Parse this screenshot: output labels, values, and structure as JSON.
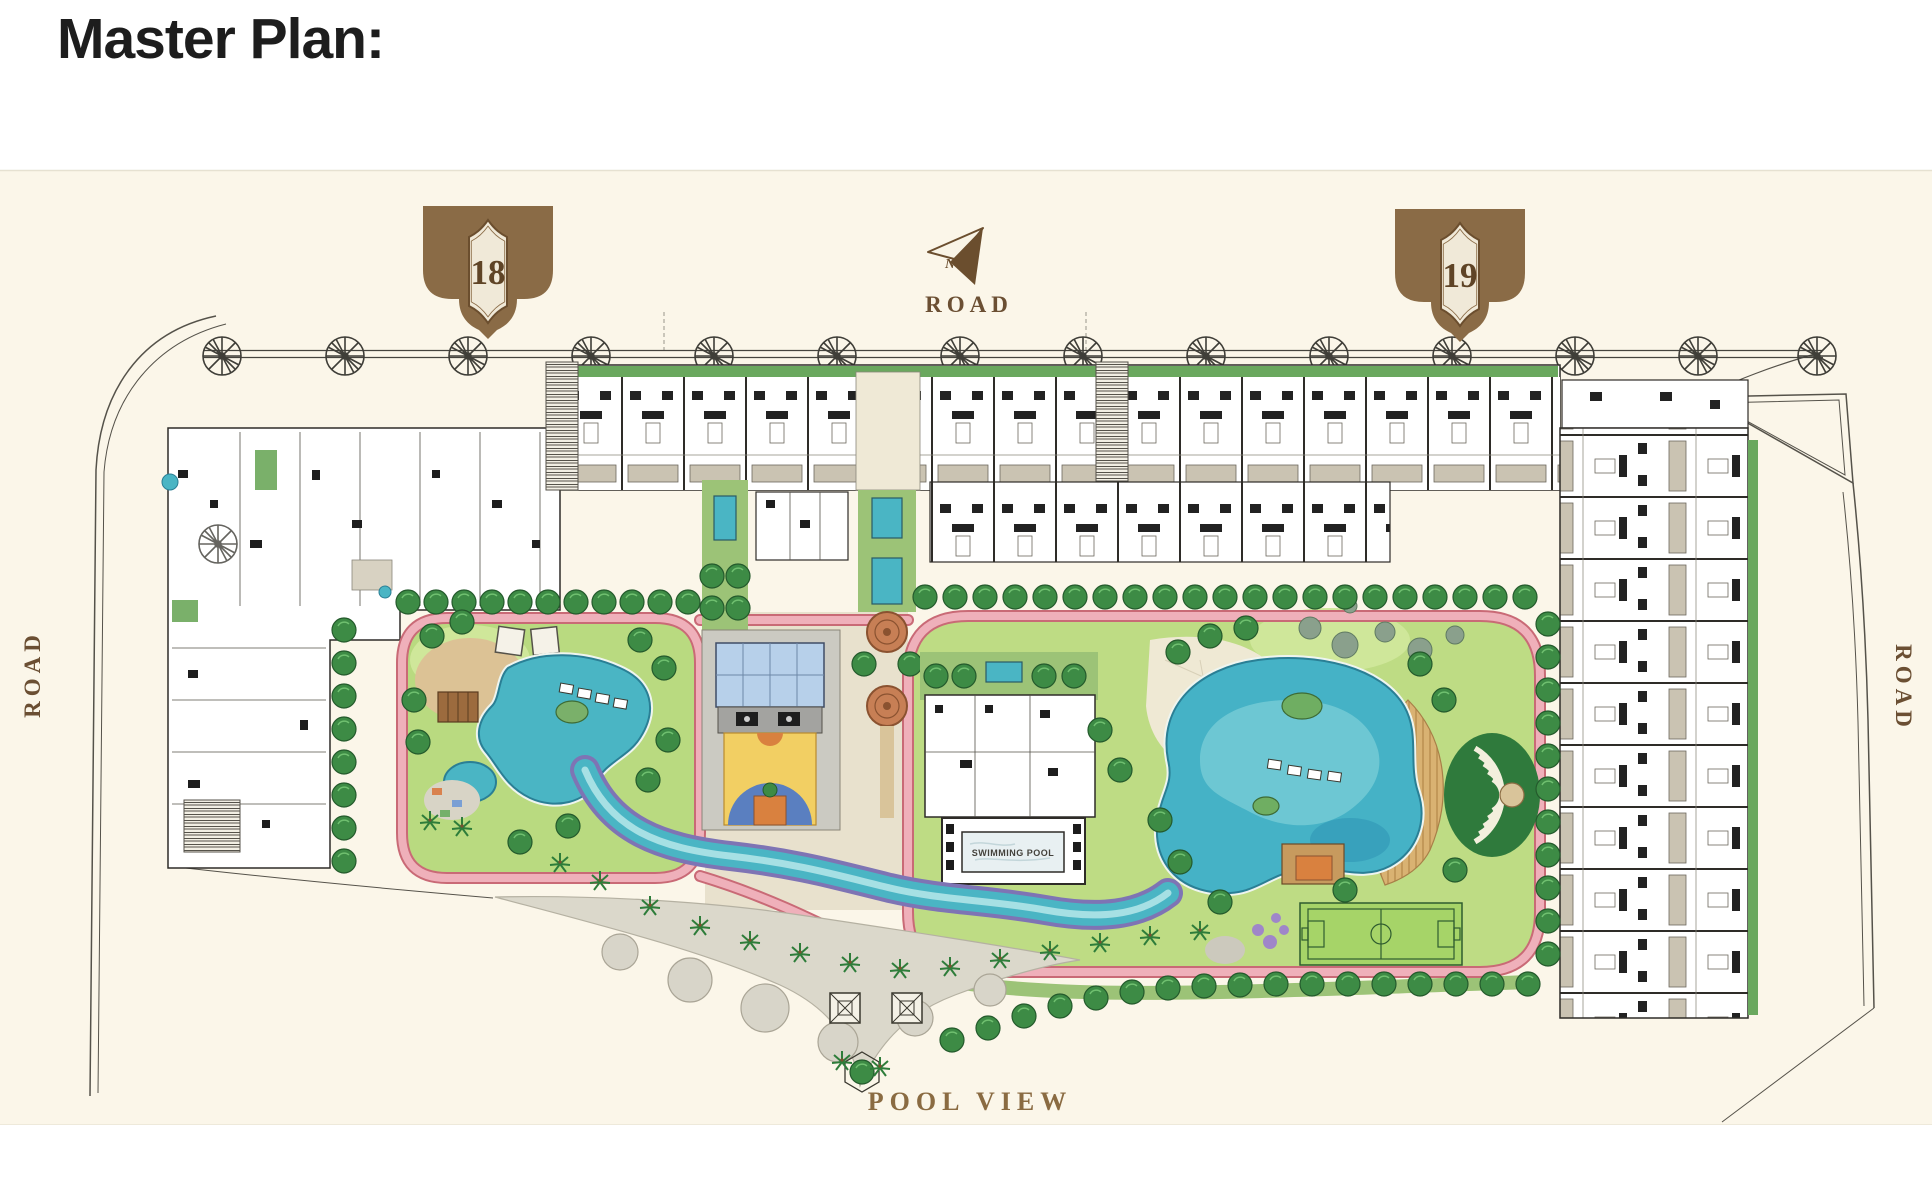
{
  "page": {
    "title": "Master Plan:"
  },
  "plan": {
    "labels": {
      "road_top": "ROAD",
      "road_left": "ROAD",
      "road_right": "ROAD",
      "pool_view": "POOL VIEW",
      "north_indicator": "N",
      "swimming_pool": "SWIMMING POOL"
    },
    "towers": [
      {
        "id": "18"
      },
      {
        "id": "19"
      }
    ],
    "colors": {
      "canvas_cream": "#fbf6e9",
      "badge_brown": "#8a6b46",
      "badge_inner_cream": "#f0e9d8",
      "label_brown": "#6b4f33",
      "pool_teal": "#4ab5c4",
      "river_purple_edge": "#7e74b4",
      "track_pink": "#efb0ba",
      "track_edge": "#c96a76",
      "lawn_green": "#b9da80",
      "hedge_green": "#3d8b45",
      "court_yellow": "#f2cf63",
      "court_blue": "#5a7fc0",
      "glass_roof_blue": "#b7d0ea",
      "field_green": "#a6d468",
      "deck_tan": "#d9b272",
      "plaza_gray": "#dbd8cb",
      "plan_linework": "#2e2c28"
    }
  }
}
